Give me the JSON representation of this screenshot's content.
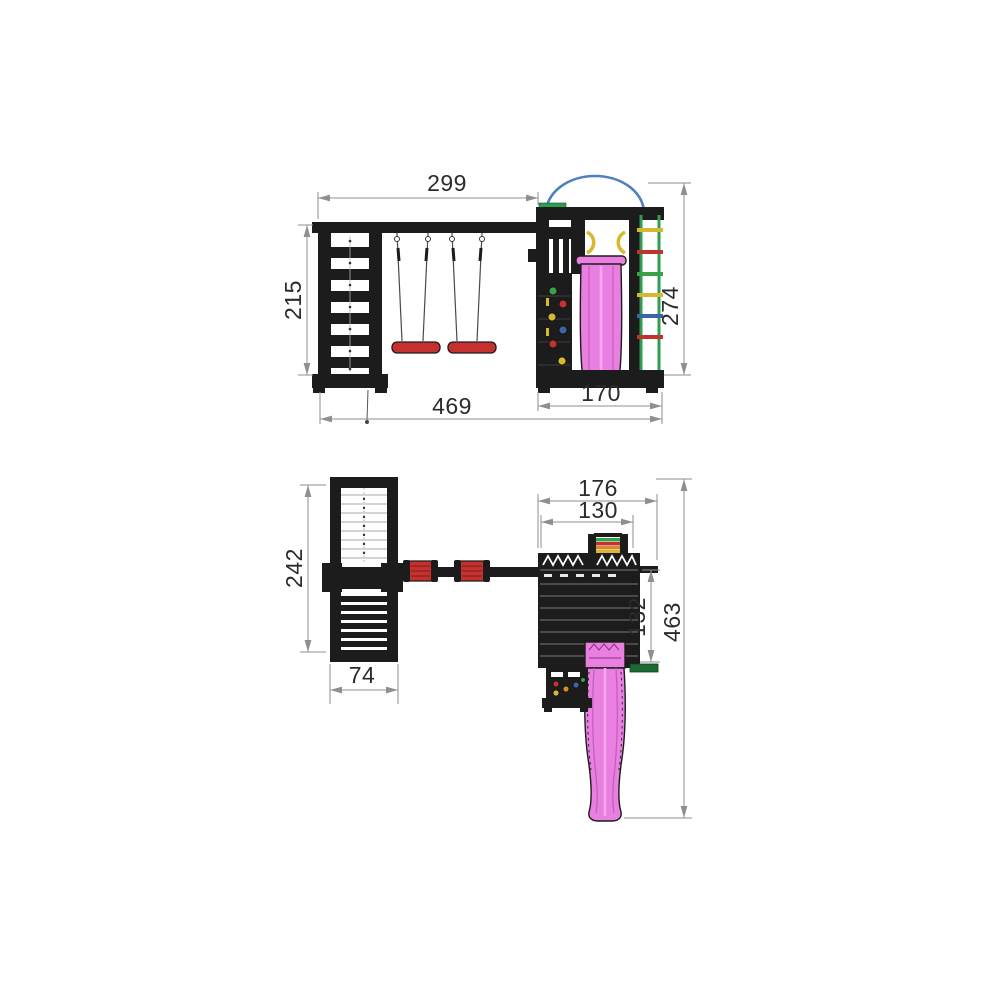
{
  "colors": {
    "structure": "#1c1c1c",
    "dimension": "#8f8f8f",
    "dim_text": "#2b2b2b",
    "slide": "#e97fe0",
    "slide_shade": "#c45cba",
    "slide_light": "#f4a9ee",
    "swing_seat": "#c4312e",
    "rail_green": "#2e9e4c",
    "bar_dark_green": "#1c6b35",
    "arc_blue": "#4f7fbf",
    "yellow": "#d7b92f",
    "red": "#c03430",
    "blue": "#3c64a8",
    "green": "#3aa04a",
    "orange": "#d8882f",
    "plank_line": "#787878"
  },
  "front_view": {
    "dims": {
      "beam_span": "299",
      "climb_frame_height": "215",
      "tower_height": "274",
      "overall_width": "469",
      "tower_width": "170"
    }
  },
  "plan_view": {
    "dims": {
      "tower_overall_depth": "176",
      "arch_width": "130",
      "climb_frame_depth": "242",
      "climb_frame_width": "74",
      "platform_depth": "132",
      "overall_depth": "463"
    }
  }
}
